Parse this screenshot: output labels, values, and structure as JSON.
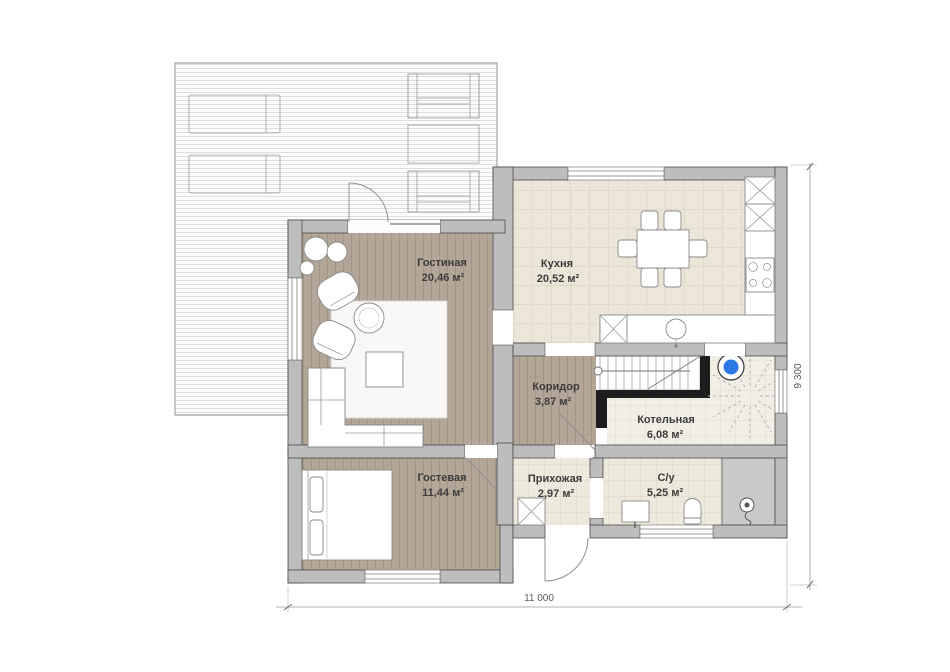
{
  "floorplan": {
    "rooms": [
      {
        "name": "Гостиная",
        "area": "20,46 м²"
      },
      {
        "name": "Кухня",
        "area": "20,52 м²"
      },
      {
        "name": "Коридор",
        "area": "3,87 м²"
      },
      {
        "name": "Котельная",
        "area": "6,08 м²"
      },
      {
        "name": "Гостевая",
        "area": "11,44 м²"
      },
      {
        "name": "Прихожая",
        "area": "2,97 м²"
      },
      {
        "name": "С/у",
        "area": "5,25 м²"
      }
    ],
    "dimensions": {
      "overall_width": "11 000",
      "overall_depth": "9 300"
    },
    "colors": {
      "wall_fill": "#bdbdbd",
      "wall_stroke": "#4a4a4a",
      "wood_floor": "#b4a697",
      "kitchen_tile": "#ebe6d8",
      "boiler_tile": "#f1eee6",
      "bath_tile": "#ede9dc",
      "shower_zone": "#c9c9c9",
      "boiler_accent": "#2b78e4",
      "deck_stripe": "#dedede"
    },
    "icons": [
      "stairs",
      "boiler-icon",
      "shower-head-icon",
      "toilet-icon",
      "sink-icon",
      "stove-icon",
      "kitchen-sink-icon",
      "wardrobe-x-icon",
      "tall-cabinet-x-icon"
    ]
  }
}
